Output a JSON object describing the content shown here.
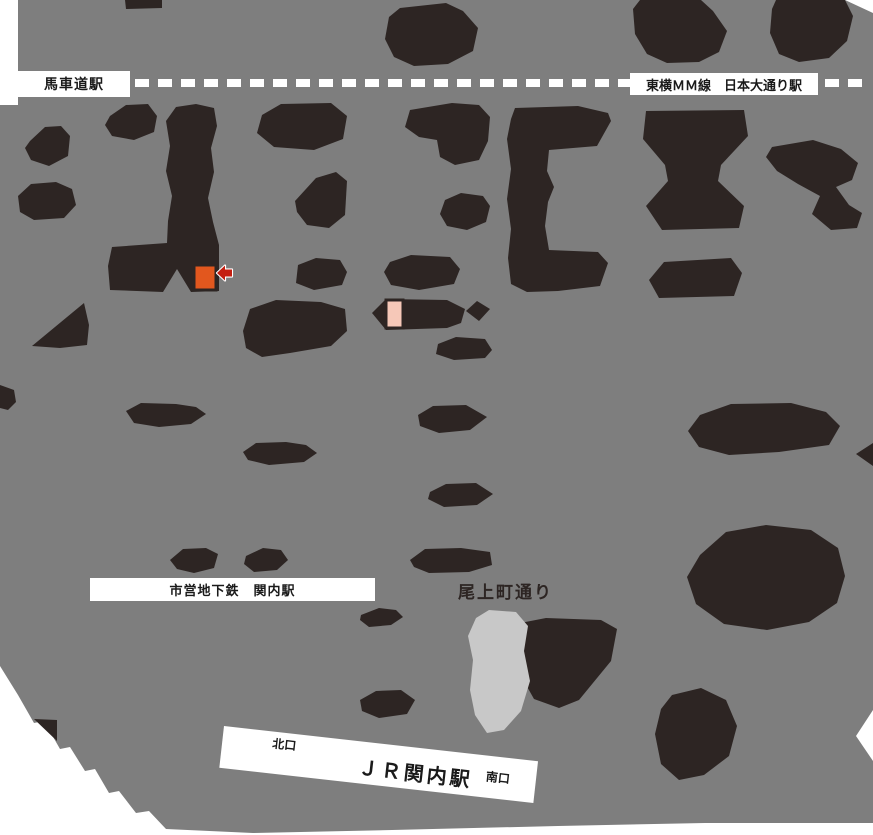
{
  "map": {
    "title": "JR関内駅周辺地図",
    "labels": {
      "bashamichi": "馬車道駅",
      "mm_line": "東横ＭＭ線　日本大通り駅",
      "subway_kannai": "市営地下鉄　関内駅",
      "onoecho_street": "尾上町通り",
      "jr_kannai": "ＪＲ関内駅",
      "north_exit": "北口",
      "south_exit": "南口"
    },
    "markers": {
      "destination": {
        "shape": "square",
        "color": "#e2571e",
        "note": "orange destination block with red arrow pointing at it"
      },
      "entrance": {
        "shape": "rect",
        "color": "#f6c8b8"
      }
    },
    "colors": {
      "canvas": "#ffffff",
      "map": "#7e7e7e",
      "building": "#2d2523",
      "park": "#c8c8c8",
      "rail": "#ffffff",
      "destination": "#e2571e",
      "entrance": "#f6c8b8",
      "arrow": "#c41e10",
      "label_bg": "#ffffff",
      "label_text": "#1a1a1a"
    },
    "rail_line_style": "white dashed line across top"
  }
}
